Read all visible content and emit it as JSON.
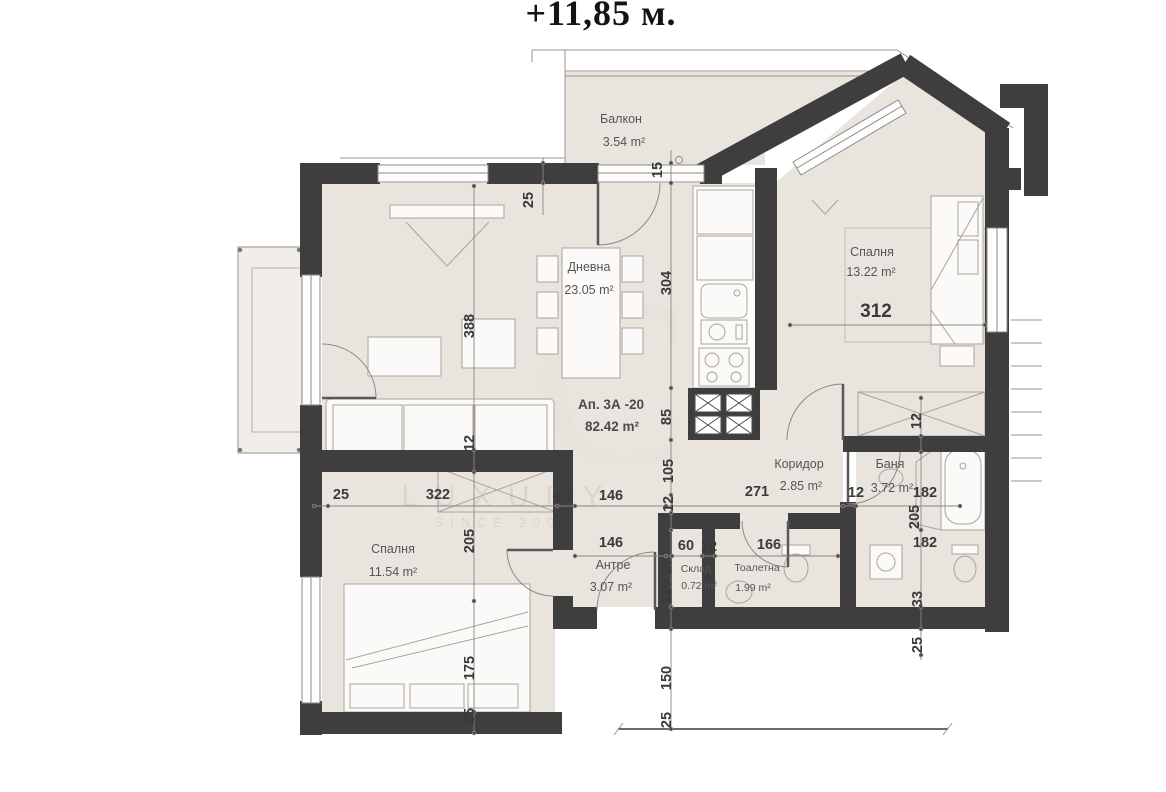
{
  "title": "+11,85 м.",
  "watermark": {
    "brand": "LUXURY",
    "since": "SINCE 2006",
    "monogram": "С"
  },
  "apartment": {
    "name": "Ап. 3А -20",
    "area": "82.42 m²"
  },
  "rooms": {
    "balcony": {
      "name": "Балкон",
      "area": "3.54 m²"
    },
    "living": {
      "name": "Дневна",
      "area": "23.05 m²"
    },
    "bedroom1": {
      "name": "Спалня",
      "area": "13.22 m²",
      "number": "312"
    },
    "bedroom2": {
      "name": "Спалня",
      "area": "11.54 m²"
    },
    "corridor": {
      "name": "Коридор",
      "area": "2.85 m²"
    },
    "bath": {
      "name": "Баня",
      "area": "3.72 m²"
    },
    "entry": {
      "name": "Антре",
      "area": "3.07 m²"
    },
    "storage": {
      "name": "Склад",
      "area": "0.72 m²"
    },
    "toilet": {
      "name": "Тоалетна",
      "area": "1.99 m²"
    }
  },
  "dims": {
    "d1": "25",
    "d2": "15",
    "d3": "304",
    "d4": "388",
    "d5": "12",
    "d6": "25",
    "d7": "322",
    "d8": "12",
    "d9": "146",
    "d10": "85",
    "d11": "105",
    "d12": "12",
    "d13": "271",
    "d14": "12",
    "d15": "182",
    "d16": "205",
    "d17": "182",
    "d18": "146",
    "d19": "60",
    "d20": "12",
    "d21": "166",
    "d22": "25",
    "d23": "120",
    "d24": "150",
    "d25": "25",
    "d26": "205",
    "d27": "175",
    "d28": "25",
    "d29": "312",
    "d30": "12",
    "d31": "33",
    "d32": "25"
  }
}
